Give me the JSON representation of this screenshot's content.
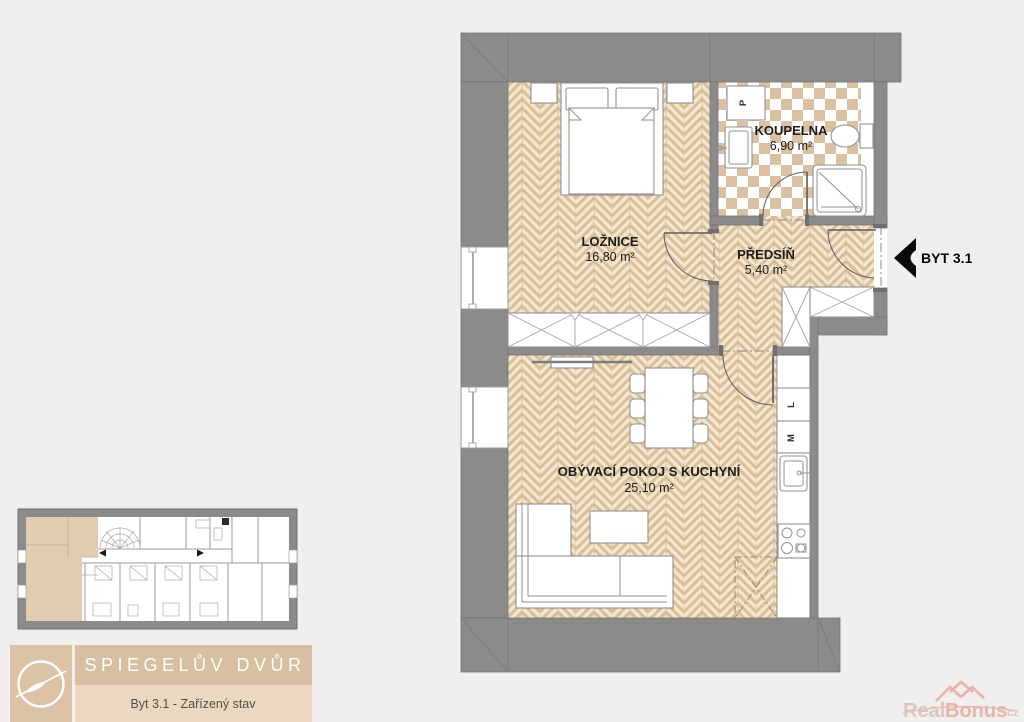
{
  "plan": {
    "entrance_label": "BYT 3.1",
    "rooms": {
      "bedroom": {
        "name": "LOŽNICE",
        "area": "16,80 m²"
      },
      "bathroom": {
        "name": "KOUPELNA",
        "area": "6,90 m²"
      },
      "hall": {
        "name": "PŘEDSÍŇ",
        "area": "5,40 m²"
      },
      "living": {
        "name": "OBÝVACÍ POKOJ S KUCHYNÍ",
        "area": "25,10 m²"
      }
    },
    "appliances": {
      "washer": "P",
      "fridge": "L",
      "dishwasher": "M"
    }
  },
  "branding": {
    "project": "SPIEGELŮV DVŮR",
    "variant": "Byt 3.1 - Zařízený stav"
  },
  "watermark": {
    "part1": "Real",
    "part2": "Bonus",
    "part3": ".cz"
  },
  "colors": {
    "background": "#f0efed",
    "wall": "#8b8b8b",
    "wood_floor": "#ecdcc0",
    "wood_plank": "#d9bd97",
    "tile_accent": "#dac1a1",
    "highlight": "#e2ccb1",
    "brand_panel": "#d9bfa1",
    "brand_panel_light": "#ead9c0",
    "watermark_red": "#de8478"
  }
}
